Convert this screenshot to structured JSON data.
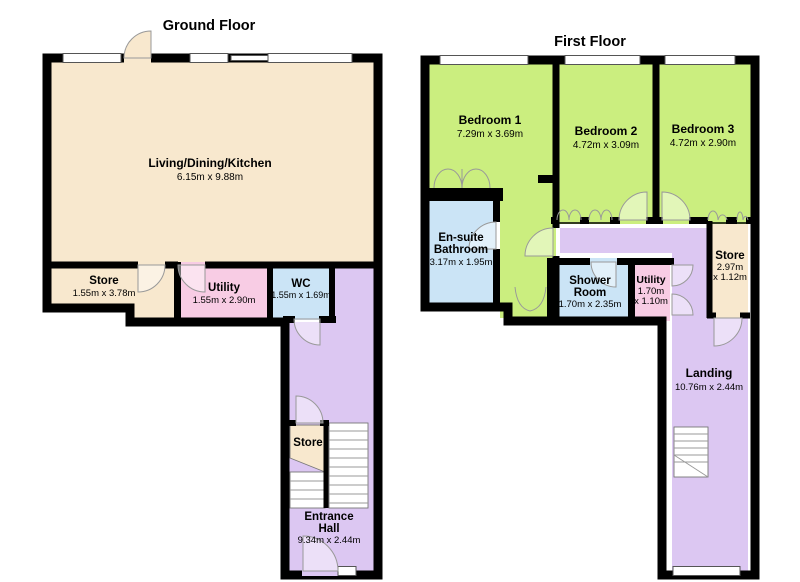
{
  "colors": {
    "cream": "#F8E8CE",
    "green": "#CBEE7F",
    "blue": "#CBE4F6",
    "pink": "#F8CCE4",
    "purple": "#DCC7F2",
    "wall": "#000000"
  },
  "ground": {
    "title": "Ground Floor",
    "rooms": {
      "living": {
        "name": "Living/Dining/Kitchen",
        "dims": "6.15m x 9.88m"
      },
      "store": {
        "name": "Store",
        "dims": "1.55m x 3.78m"
      },
      "utility": {
        "name": "Utility",
        "dims": "1.55m x 2.90m"
      },
      "wc": {
        "name": "WC",
        "dims": "1.55m x 1.69m"
      },
      "stair_store": {
        "name": "Store"
      },
      "hall": {
        "name1": "Entrance",
        "name2": "Hall",
        "dims": "9.34m x 2.44m"
      }
    }
  },
  "first": {
    "title": "First Floor",
    "rooms": {
      "bed1": {
        "name": "Bedroom 1",
        "dims": "7.29m x 3.69m"
      },
      "bed2": {
        "name": "Bedroom 2",
        "dims": "4.72m x 3.09m"
      },
      "bed3": {
        "name": "Bedroom 3",
        "dims": "4.72m x 2.90m"
      },
      "ensuite": {
        "name1": "En-suite",
        "name2": "Bathroom",
        "dims": "3.17m x 1.95m"
      },
      "shower": {
        "name1": "Shower",
        "name2": "Room",
        "dims": "1.70m x 2.35m"
      },
      "utility": {
        "name": "Utility",
        "dims1": "1.70m",
        "dims2": "x 1.10m"
      },
      "store": {
        "name": "Store",
        "dims1": "2.97m",
        "dims2": "x 1.12m"
      },
      "landing": {
        "name": "Landing",
        "dims": "10.76m x 2.44m"
      }
    }
  }
}
